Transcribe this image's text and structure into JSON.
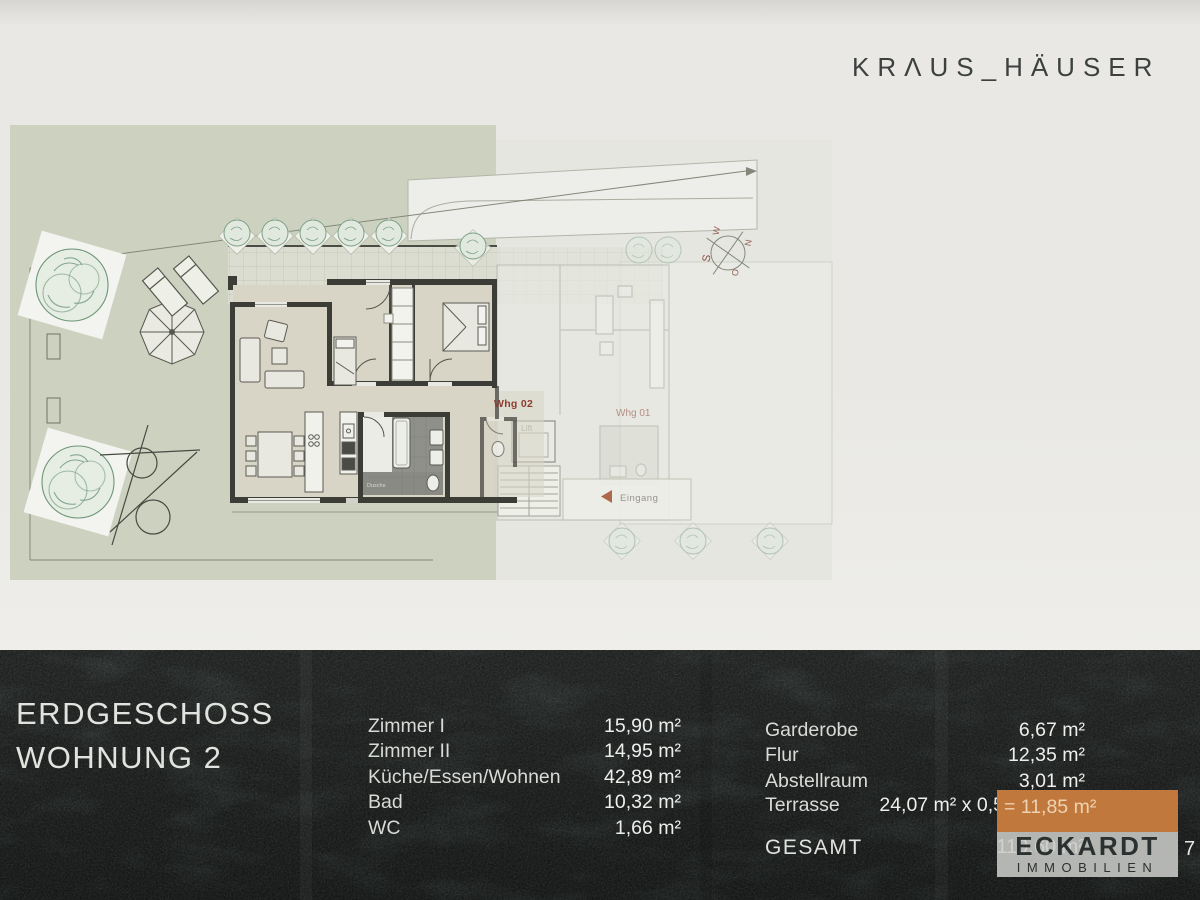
{
  "brand": {
    "logo_text": "KRΛUS_HÄUSER"
  },
  "plan": {
    "labels": {
      "whg02": "Whg 02",
      "whg01": "Whg 01",
      "lift": "Lift",
      "eingang": "Eingang",
      "dusche": "Dusche",
      "compass": {
        "n": "N",
        "o": "O",
        "s": "S",
        "w": "W"
      }
    }
  },
  "footer": {
    "title_line1": "ERDGESCHOSS",
    "title_line2": "WOHNUNG 2",
    "rooms_left": [
      {
        "label": "Zimmer I",
        "value": "15,90 m²"
      },
      {
        "label": "Zimmer II",
        "value": "14,95 m²"
      },
      {
        "label": "Küche/Essen/Wohnen",
        "value": "42,89 m²"
      },
      {
        "label": "Bad",
        "value": "10,32 m²"
      },
      {
        "label": "WC",
        "value": "1,66 m²"
      }
    ],
    "rooms_right": [
      {
        "label": "Garderobe",
        "value": "6,67 m²"
      },
      {
        "label": "Flur",
        "value": "12,35 m²"
      },
      {
        "label": "Abstellraum",
        "value": "3,01 m²"
      }
    ],
    "terrasse": {
      "label": "Terrasse",
      "calc": "24,07 m² x 0,5",
      "result": "= 11,85 m²"
    },
    "gesamt": {
      "label": "GESAMT",
      "value": "119,60 m²"
    },
    "page_number": "7",
    "colors": {
      "accent_orange": "#c0783d",
      "footer_bg": "#343a38"
    }
  },
  "logo_box": {
    "line1": "ECKARDT",
    "line2": "IMMOBILIEN"
  }
}
